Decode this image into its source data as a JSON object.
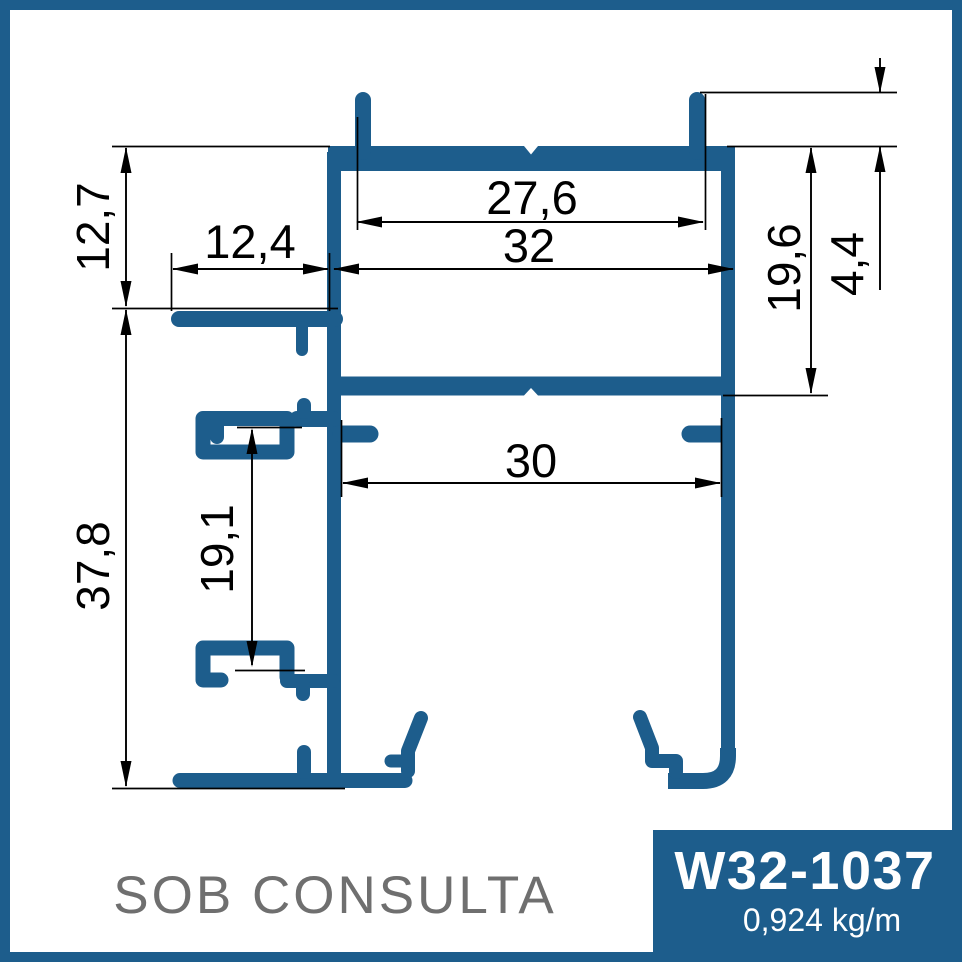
{
  "colors": {
    "profile": "#1d5d8c",
    "border": "#1d5d8c",
    "badge_bg": "#1d5d8c",
    "badge_text": "#ffffff",
    "dimension": "#000000",
    "muted_text": "#6f6f6f"
  },
  "drawing": {
    "availability_note": "SOB CONSULTA",
    "badge": {
      "code": "W32-1037",
      "weight": "0,924 kg/m"
    },
    "dimensions": {
      "tab_span_top": "27,6",
      "outer_width": "32",
      "left_arm_length": "12,4",
      "top_offset": "12,7",
      "upper_chamber_depth": "19,6",
      "tab_height": "4,4",
      "inner_width": "30",
      "clip_spacing": "19,1",
      "body_height": "37,8"
    }
  }
}
